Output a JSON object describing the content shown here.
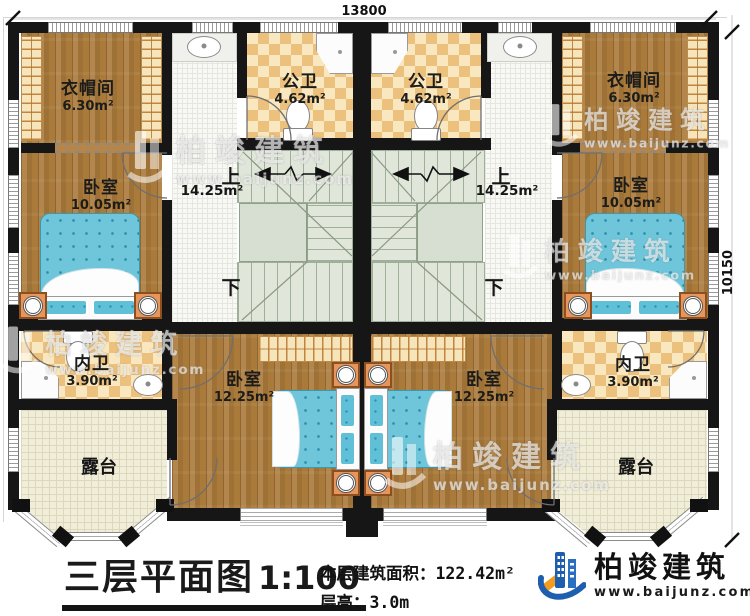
{
  "plan": {
    "dimensions": {
      "width": "13800",
      "height": "10150"
    },
    "units": {
      "left": {
        "cloakroom": {
          "name": "衣帽间",
          "area": "6.30m²"
        },
        "public_bath": {
          "name": "公卫",
          "area": "4.62m²"
        },
        "bedroom_upper": {
          "name": "卧室",
          "area": "10.05m²"
        },
        "stairs": {
          "up": "上",
          "down": "下",
          "area": "14.25m²"
        },
        "ensuite_bath": {
          "name": "内卫",
          "area": "3.90m²"
        },
        "bedroom_lower": {
          "name": "卧室",
          "area": "12.25m²"
        },
        "terrace": {
          "name": "露台"
        }
      },
      "right": {
        "cloakroom": {
          "name": "衣帽间",
          "area": "6.30m²"
        },
        "public_bath": {
          "name": "公卫",
          "area": "4.62m²"
        },
        "bedroom_upper": {
          "name": "卧室",
          "area": "10.05m²"
        },
        "stairs": {
          "up": "上",
          "down": "下",
          "area": "14.25m²"
        },
        "ensuite_bath": {
          "name": "内卫",
          "area": "3.90m²"
        },
        "bedroom_lower": {
          "name": "卧室",
          "area": "12.25m²"
        },
        "terrace": {
          "name": "露台"
        }
      }
    }
  },
  "footer": {
    "title": "三层平面图",
    "scale": "1:100",
    "floor_area_label": "本层建筑面积：",
    "floor_area_value": "122.42m²",
    "floor_height_label": "层高：",
    "floor_height_value": "3.0m"
  },
  "brand": {
    "name": "柏竣建筑",
    "website": "www.baijunz.com"
  },
  "watermark": {
    "name": "柏竣建筑",
    "website": "www.baijunz.com"
  }
}
